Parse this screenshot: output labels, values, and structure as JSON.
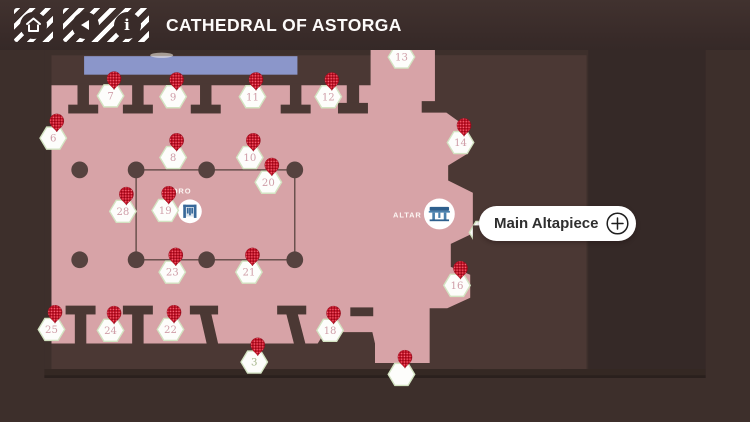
{
  "header": {
    "title": "CATHEDRAL OF ASTORGA",
    "buttons": [
      {
        "id": "home",
        "icon": "home-icon"
      },
      {
        "id": "back",
        "icon": "back-arrow-icon"
      },
      {
        "id": "info",
        "icon": "info-icon"
      }
    ]
  },
  "map": {
    "region_labels": {
      "coro": "CORO",
      "altar": "ALTAR"
    },
    "callout": {
      "label": "Main Altapiece",
      "action_icon": "plus-icon"
    },
    "colors": {
      "floor": "#d7a3a7",
      "wall": "#4b3834",
      "background": "#3d2f2b",
      "background_right": "#352927",
      "entrance_blue": "#8b96ca",
      "pin_red": "#cd1126",
      "hex_fill": "#fdfdfb",
      "hex_border": "#d3e3c2",
      "marker_number": "#cf9ea8",
      "marker_number_alt": "#a3b489",
      "poi_icon_blue": "#38699a"
    },
    "markers": [
      {
        "n": "7",
        "x": 75,
        "y": 102
      },
      {
        "n": "9",
        "x": 146,
        "y": 103
      },
      {
        "n": "11",
        "x": 236,
        "y": 103
      },
      {
        "n": "12",
        "x": 322,
        "y": 103
      },
      {
        "n": "13",
        "x": 405,
        "y": 58,
        "pin": false
      },
      {
        "n": "6",
        "x": 10,
        "y": 150
      },
      {
        "n": "8",
        "x": 146,
        "y": 172
      },
      {
        "n": "10",
        "x": 233,
        "y": 172
      },
      {
        "n": "14",
        "x": 472,
        "y": 155
      },
      {
        "n": "20",
        "x": 254,
        "y": 200
      },
      {
        "n": "28",
        "x": 89,
        "y": 233
      },
      {
        "n": "19",
        "x": 137,
        "y": 232
      },
      {
        "n": "23",
        "x": 145,
        "y": 302
      },
      {
        "n": "21",
        "x": 232,
        "y": 302
      },
      {
        "n": "16",
        "x": 468,
        "y": 317
      },
      {
        "n": "25",
        "x": 8,
        "y": 367
      },
      {
        "n": "24",
        "x": 75,
        "y": 368
      },
      {
        "n": "22",
        "x": 143,
        "y": 367
      },
      {
        "n": "18",
        "x": 324,
        "y": 368
      },
      {
        "n": "3",
        "x": 238,
        "y": 404,
        "alt": true
      },
      {
        "n": "",
        "x": 405,
        "y": 418
      },
      {
        "n": "",
        "x": 497,
        "y": 257,
        "pin": false
      },
      {
        "n": "",
        "x": 533,
        "y": 257,
        "pin": false
      }
    ]
  }
}
